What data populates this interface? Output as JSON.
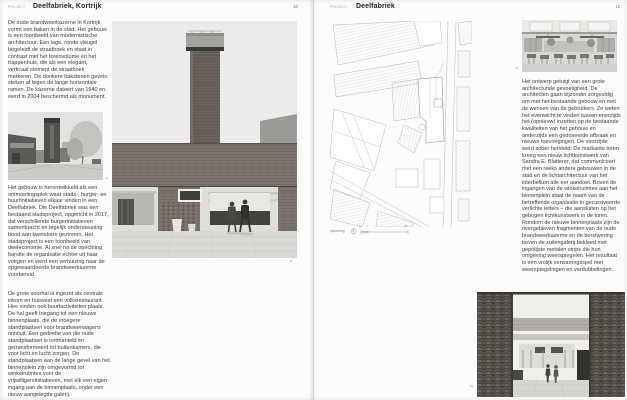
{
  "colors": {
    "paper": "#fcfcfb",
    "ink": "#3e3e3e",
    "muted": "#9a9a9a",
    "rule": "#d6d6d4"
  },
  "left_page": {
    "header": {
      "label": "PROJECT",
      "title": "Deelfabriek, Kortrijk",
      "page_number": "10"
    },
    "paragraphs": [
      "De oude brandweerkazerne in Kortrijk vormt een baken in de stad. Het gebouw is een toonbeeld van modernistische architectuur. Een lage, ronde vleugel begeleidt de straathoek en staat in contrast met het torenvolume en het trappenhuis, die als een elegant, verticaal element de straathoek markeren. De donkere bakstenen gevels steken af tegen de lange horizontale ramen. De kazerne dateert van 1940 en werd in 2004 beschermd als monument.",
      "Het gebouw is herontwikkeld als een ontmoetingsplek waar stads-, burger- en buurtinitiatieven elkaar vinden in een Deelfabriek. Die Deelfabriek was een bestaand stadsproject, opgericht in 2017, dat verschillende burgerinitiatieven samenbracht en tegelijk ondersteuning bood aan kwetsbare gezinnen. Het stadsproject is een toonbeeld van deeleconomie. Al snel na de oprichting barstte de organisatie echter uit haar voegen en werd een verhuizing naar de opgewaardeerde brandweerkazerne voorbereid.",
      "De grote voorhal is ingezet als centrale inkom en huisvest een volksrestaurant. Hier vinden ook buurtactiviteiten plaats. De hal geeft toegang tot een nieuwe binnenplaats, die de vroegere standplaatsen voor brandweerwagens ontsluit. Een gedeelte van die oude standplaatsen is ontmanteld en getransformeerd tot buitenkamers, die voor licht en lucht zorgen. De standplaatsen aan de lange gevel van het binnenplein zijn omgevormd tot winkelruimtes voor de vrijwilligersinitiatieven, met elk een eigen ingang aan de binnenplaats, onder een nieuw aangelegde galerij."
    ],
    "figures": {
      "street_photo": {
        "number": "01"
      },
      "courtyard_photo": {
        "number": "02"
      }
    }
  },
  "right_page": {
    "header": {
      "label": "PROJECT",
      "title": "Deelfabriek",
      "page_number": "11"
    },
    "site_plan": {
      "caption": "inplanting",
      "scale_ticks": [
        "0",
        "5",
        "25"
      ]
    },
    "paragraph": "Het ontwerp getuigt van een grote architecturale gevoeligheid. De architecten gaan bijzonder zorgvuldig om met het bestaande gebouw en met de wensen van de gebruikers. Ze weten het evenwicht te vinden tussen enerzijds het (opnieuw) inzetten op de bestaande kwaliteiten van het gebouw en anderzijds een gedoseerde afbraak en nieuwe toevoegingen. De voorzijde werd sober hersteld. De markante toren kreeg een nieuw lichtkunstwerk van Sandra E. Blatterer, dat communiceert met een reeks andere gebouwen in de stad en de lichtarchitectuur van het interbellum alle eer aandoet. Boven de ingangen van de winkelruimtes aan het binnenplein staat de naam van de betreffende organisatie in gecursiveerde verlichte letters – die aansluiten op het gebogen lichtkunstwerk in de toren. Rondom de nieuwe binnenplaats zijn de overgebleven fragmenten van de oude brandweerkazerne en de borstwering boven de zuilengalerij bekleed met gepolijste metalen strips die hun omgeving weerspiegelen. Het resultaat is een vrolijk verwarringsspel met weerspiegelingen en verdubbelingen.",
    "figures": {
      "restaurant_photo": {
        "number": "03"
      },
      "gate_photo": {
        "number": "04"
      }
    }
  }
}
